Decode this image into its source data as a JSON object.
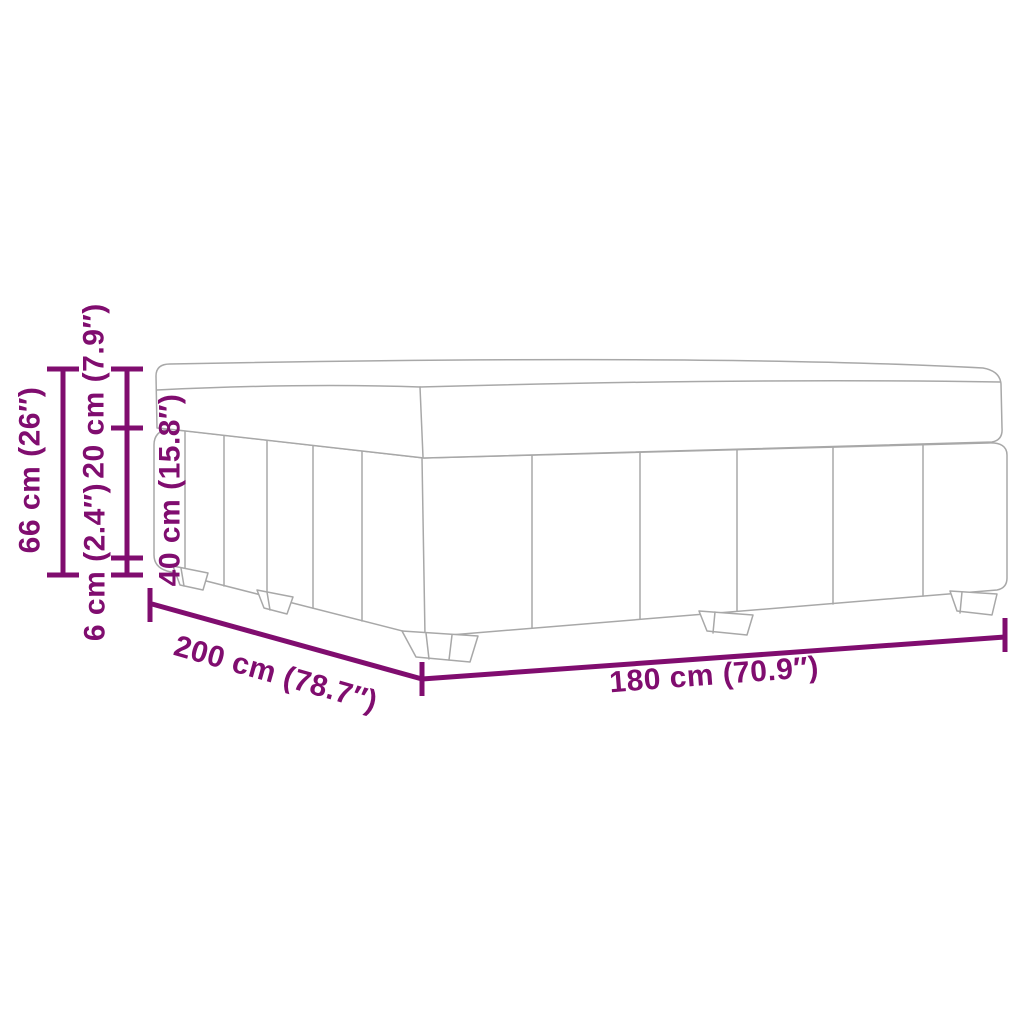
{
  "diagram": {
    "type": "product-dimension-diagram",
    "subject": "boxspring-bed-with-legs",
    "accent_color": "#800D6F",
    "outline_color": "#A8A8A8",
    "labels": {
      "total_height": "66 cm (26″)",
      "mattress_height": "20 cm (7.9″)",
      "leg_height": "6 cm (2.4″)",
      "base_height": "40 cm (15.8″)",
      "length": "200 cm (78.7″)",
      "width": "180 cm (70.9″)"
    }
  }
}
